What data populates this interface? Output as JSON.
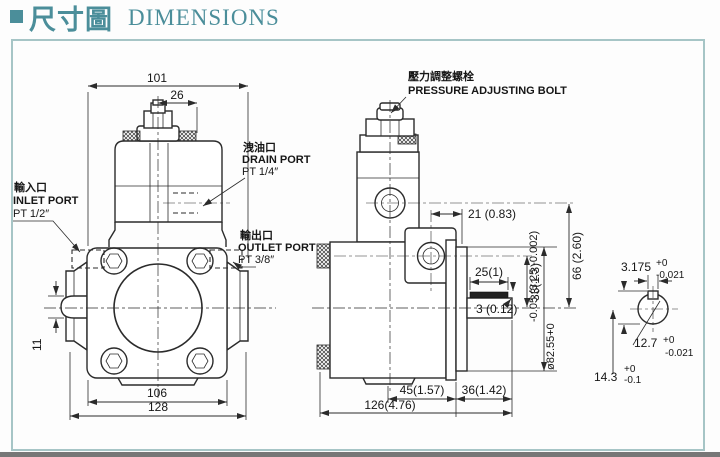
{
  "header": {
    "title_zh": "尺寸圖",
    "title_en": "DIMENSIONS"
  },
  "front_view": {
    "dims": {
      "overall_top": "101",
      "cap": "26",
      "bolt_span": "106",
      "overall_bottom": "128",
      "port_height": "11"
    },
    "inlet_port": {
      "label_zh": "輸入口",
      "label_en": "INLET PORT",
      "thread": "PT 1/2″"
    },
    "outlet_port": {
      "label_zh": "輸出口",
      "label_en": "OUTLET PORT",
      "thread": "PT 3/8″"
    },
    "drain_port": {
      "label_zh": "洩油口",
      "label_en": "DRAIN PORT",
      "thread": "PT 1/4″"
    }
  },
  "side_view": {
    "pressure_bolt": {
      "label_zh": "壓力調整螺栓",
      "label_en": "PRESSURE ADJUSTING BOLT"
    },
    "dims": {
      "port_offset": "21  (0.83)",
      "center_height": "66 (2.60)",
      "port_to_shaft": "33(1.3)",
      "key_length": "25(1)",
      "key_height": "3 (0.12)",
      "spigot_dia_metric": "ø82.55+0",
      "spigot_dia_tol": "-0.05 (3.25 -0.002)",
      "body_to_face": "45(1.57)",
      "face_to_shaft_end": "36(1.42)",
      "overall_length": "126(4.76)"
    }
  },
  "shaft_detail": {
    "key_width": {
      "value": "3.175",
      "tol_plus": "+0",
      "tol_minus": "-0.021"
    },
    "shaft_dia": {
      "value": "12.7",
      "tol_plus": "+0",
      "tol_minus": "-0.021"
    },
    "overall_height": {
      "value": "14.3",
      "tol_plus": "+0",
      "tol_minus": "-0.1"
    }
  },
  "colors": {
    "accent": "#4b8e9a",
    "line": "#2b2b2b",
    "frame": "#a6c5c6"
  }
}
